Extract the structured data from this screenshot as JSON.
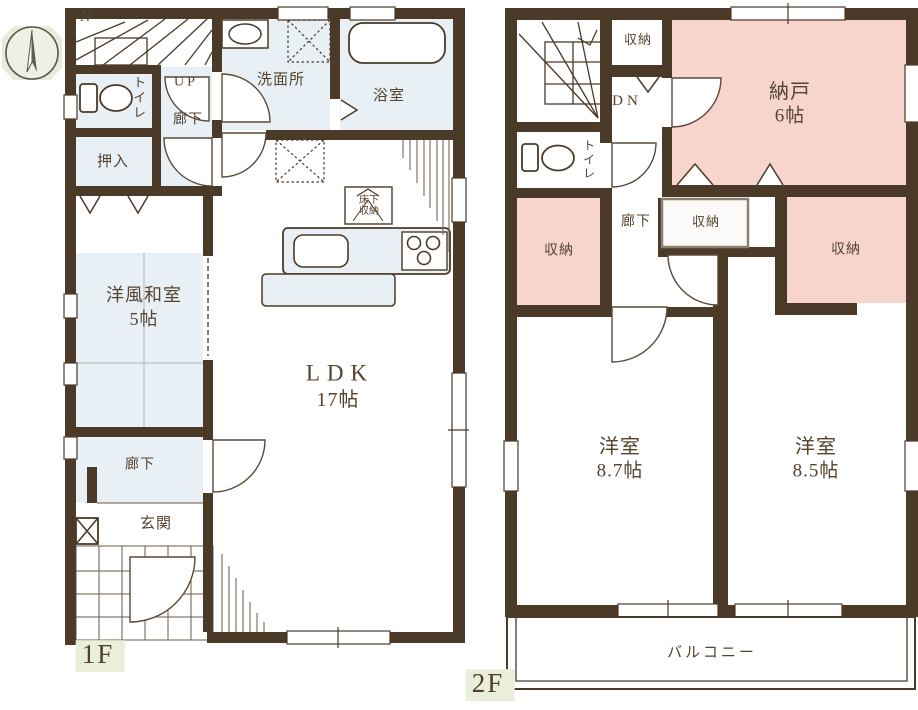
{
  "compass": {
    "north_label": "N"
  },
  "floor1": {
    "floor_label": "1F",
    "stairs_direction": "UP",
    "rooms": {
      "toilet": "トイレ",
      "upper_hallway": "廊下",
      "closet_oshiire": "押入",
      "washroom": "洗面所",
      "bathroom": "浴室",
      "japanese_room": "洋風和室",
      "japanese_room_size": "5帖",
      "ldk": "LDK",
      "ldk_size": "17帖",
      "underfloor_storage": "床下収納",
      "hallway": "廊下",
      "entrance": "玄関"
    }
  },
  "floor2": {
    "floor_label": "2F",
    "stairs_direction": "DN",
    "rooms": {
      "closet_top": "収納",
      "toilet": "トイレ",
      "storage_room": "納戸",
      "storage_room_size": "6帖",
      "closet_left": "収納",
      "hallway": "廊下",
      "closet_middle": "収納",
      "closet_right": "収納",
      "bedroom_left": "洋室",
      "bedroom_left_size": "8.7帖",
      "bedroom_right": "洋室",
      "bedroom_right_size": "8.5帖",
      "balcony": "バルコニー"
    }
  },
  "colors": {
    "wall": "#4b3a27",
    "room_blue": "#e9f0f5",
    "room_pink": "#f7d5cd",
    "label_bg_green": "#e9efd9",
    "text": "#55432f"
  }
}
